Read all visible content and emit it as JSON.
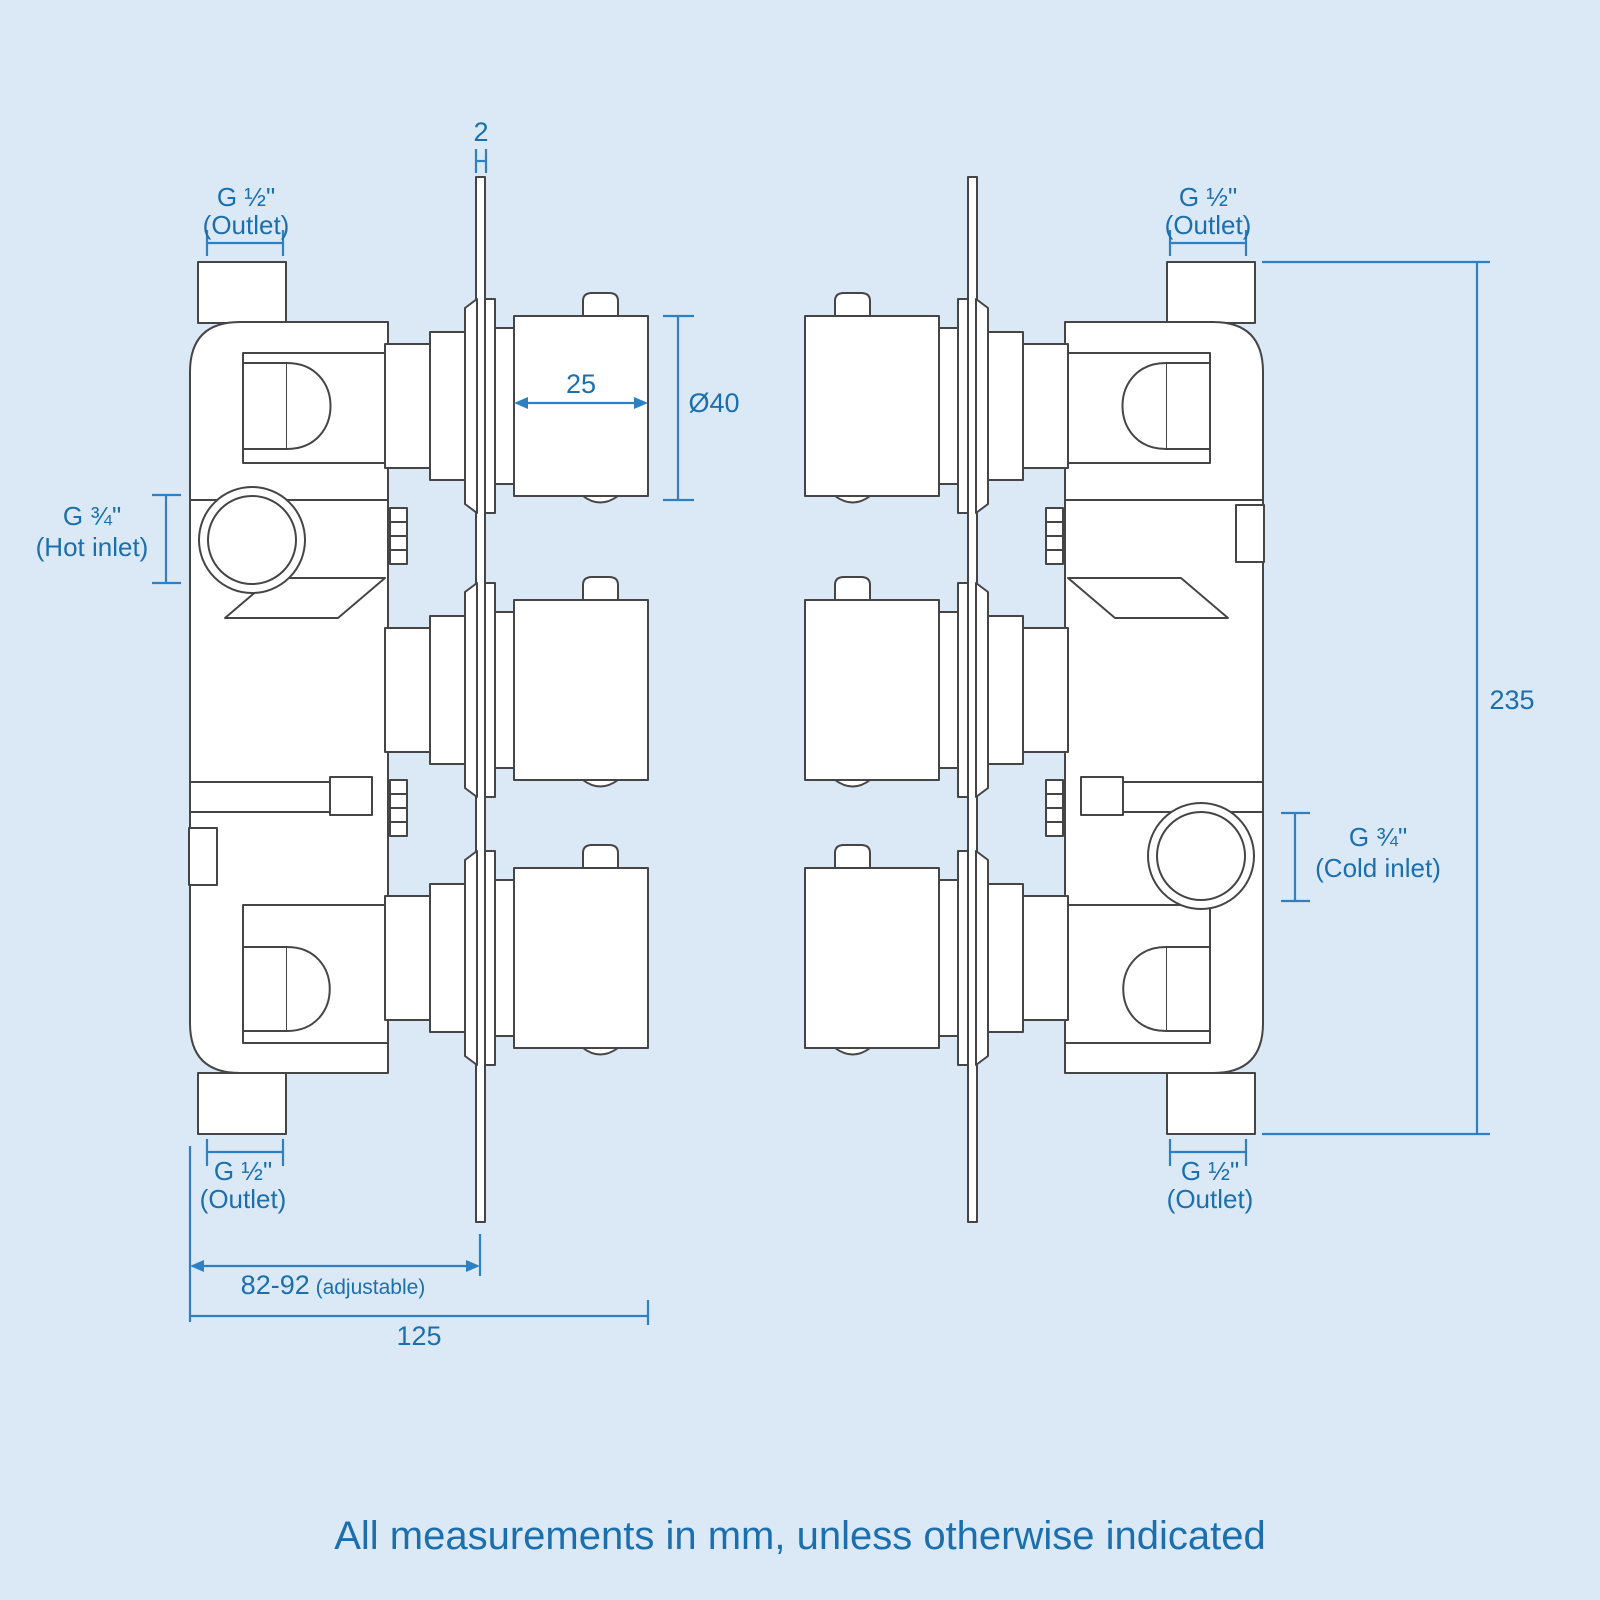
{
  "colors": {
    "background": "#dbe9f7",
    "drawing_line": "#454545",
    "dimension_line": "#2e80c2",
    "label_text": "#1c6fad"
  },
  "caption": "All measurements in mm, unless otherwise indicated",
  "left_view": {
    "plate_thickness": "2",
    "top_outlet": {
      "size": "G ½\"",
      "label": "(Outlet)"
    },
    "handle_width": "25",
    "handle_diameter": "Ø40",
    "hot_inlet": {
      "size": "G ¾\"",
      "label": "(Hot inlet)"
    },
    "bottom_outlet": {
      "size": "G ½\"",
      "label": "(Outlet)"
    },
    "wall_depth": {
      "value": "82-92",
      "qualifier": "(adjustable)"
    },
    "overall_depth": "125"
  },
  "right_view": {
    "top_outlet": {
      "size": "G ½\"",
      "label": "(Outlet)"
    },
    "cold_inlet": {
      "size": "G ¾\"",
      "label": "(Cold inlet)"
    },
    "bottom_outlet": {
      "size": "G ½\"",
      "label": "(Outlet)"
    },
    "overall_height": "235"
  }
}
